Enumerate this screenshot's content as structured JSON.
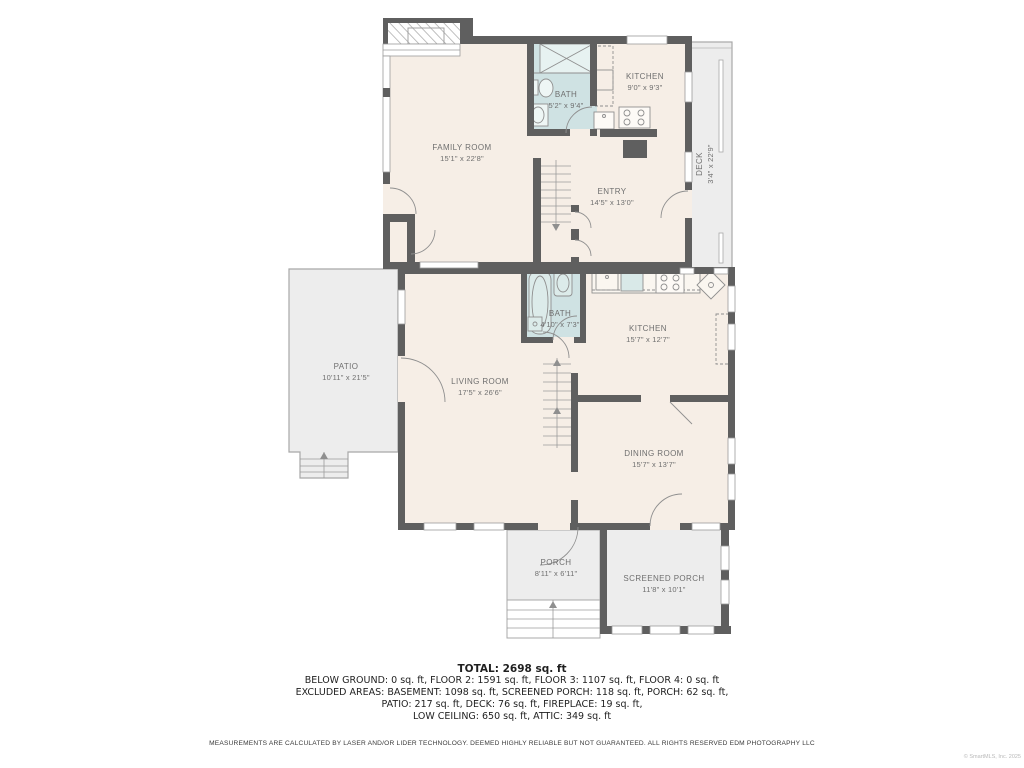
{
  "plan": {
    "rooms": {
      "family": {
        "name": "FAMILY ROOM",
        "dims": "15'1\" x 22'8\""
      },
      "bath_upper": {
        "name": "BATH",
        "dims": "5'2\" x 9'4\""
      },
      "kitchen_upper": {
        "name": "KITCHEN",
        "dims": "9'0\" x 9'3\""
      },
      "entry": {
        "name": "ENTRY",
        "dims": "14'5\" x 13'0\""
      },
      "deck": {
        "name": "DECK",
        "dims": "3'4\" x 22'9\""
      },
      "patio": {
        "name": "PATIO",
        "dims": "10'11\" x 21'5\""
      },
      "living": {
        "name": "LIVING ROOM",
        "dims": "17'5\" x 26'6\""
      },
      "bath_main": {
        "name": "BATH",
        "dims": "4'10\" x 7'3\""
      },
      "kitchen_main": {
        "name": "KITCHEN",
        "dims": "15'7\" x 12'7\""
      },
      "dining": {
        "name": "DINING ROOM",
        "dims": "15'7\" x 13'7\""
      },
      "porch": {
        "name": "PORCH",
        "dims": "8'11\" x 6'11\""
      },
      "screened_porch": {
        "name": "SCREENED PORCH",
        "dims": "11'8\" x 10'1\""
      }
    },
    "colors": {
      "wall": "#5f5f5f",
      "room": "#f6eee6",
      "bath": "#cfe2e3",
      "outdooor": "#ededed",
      "label": "#6f6f6f"
    }
  },
  "summary": {
    "total": "TOTAL: 2698 sq. ft",
    "line1": "BELOW GROUND: 0 sq. ft, FLOOR 2: 1591 sq. ft, FLOOR 3: 1107 sq. ft, FLOOR 4: 0 sq. ft",
    "line2": "EXCLUDED AREAS: BASEMENT: 1098 sq. ft, SCREENED PORCH: 118 sq. ft, PORCH: 62 sq. ft,",
    "line3": "PATIO: 217 sq. ft, DECK: 76 sq. ft, FIREPLACE: 19 sq. ft,",
    "line4": "LOW CEILING: 650 sq. ft, ATTIC: 349 sq. ft"
  },
  "disclaimer": "MEASUREMENTS ARE CALCULATED BY LASER AND/OR LIDER TECHNOLOGY. DEEMED HIGHLY RELIABLE BUT NOT GUARANTEED. ALL RIGHTS RESERVED EDM PHOTOGRAPHY LLC",
  "watermark": "© SmartMLS, Inc. 2025"
}
